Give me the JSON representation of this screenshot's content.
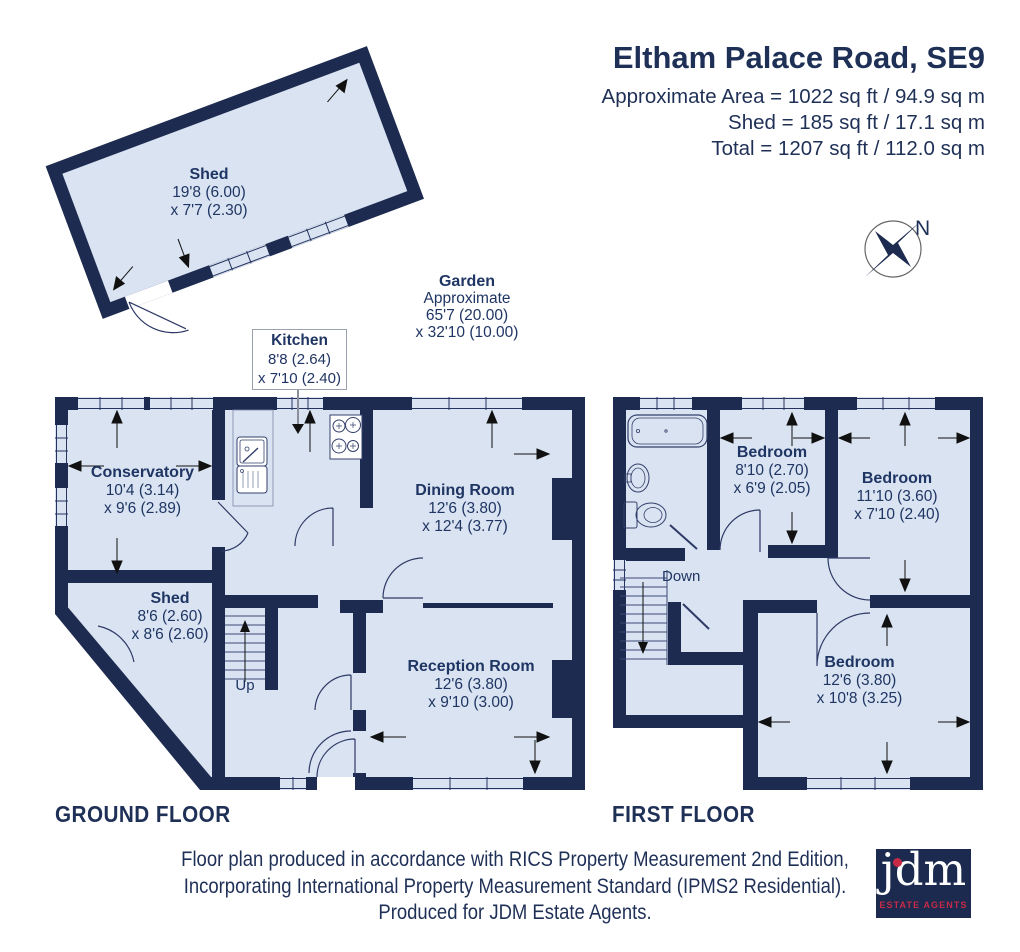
{
  "header": {
    "title": "Eltham Palace Road, SE9",
    "area_lines": [
      "Approximate Area = 1022 sq ft / 94.9 sq m",
      "Shed = 185 sq ft / 17.1 sq m",
      "Total = 1207 sq ft / 112.0 sq m"
    ]
  },
  "compass": {
    "north_label": "N"
  },
  "outbuilding_shed": {
    "name": "Shed",
    "dims": [
      "19'8 (6.00)",
      "x 7'7 (2.30)"
    ]
  },
  "garden": {
    "name": "Garden",
    "lines": [
      "Approximate",
      "65'7 (20.00)",
      "x 32'10 (10.00)"
    ]
  },
  "kitchen_callout": {
    "name": "Kitchen",
    "dims": [
      "8'8 (2.64)",
      "x 7'10 (2.40)"
    ]
  },
  "ground_floor": {
    "label": "GROUND FLOOR",
    "stairs_label": "Up",
    "rooms": {
      "conservatory": {
        "name": "Conservatory",
        "dims": [
          "10'4 (3.14)",
          "x 9'6 (2.89)"
        ]
      },
      "shed": {
        "name": "Shed",
        "dims": [
          "8'6 (2.60)",
          "x 8'6 (2.60)"
        ]
      },
      "dining": {
        "name": "Dining Room",
        "dims": [
          "12'6 (3.80)",
          "x 12'4 (3.77)"
        ]
      },
      "reception": {
        "name": "Reception Room",
        "dims": [
          "12'6 (3.80)",
          "x 9'10 (3.00)"
        ]
      }
    }
  },
  "first_floor": {
    "label": "FIRST FLOOR",
    "stairs_label": "Down",
    "rooms": {
      "bedroom_front": {
        "name": "Bedroom",
        "dims": [
          "8'10 (2.70)",
          "x 6'9 (2.05)"
        ]
      },
      "bedroom_right": {
        "name": "Bedroom",
        "dims": [
          "11'10 (3.60)",
          "x 7'10 (2.40)"
        ]
      },
      "bedroom_back": {
        "name": "Bedroom",
        "dims": [
          "12'6 (3.80)",
          "x 10'8 (3.25)"
        ]
      }
    }
  },
  "footer": {
    "lines": [
      "Floor plan produced in accordance with RICS Property Measurement 2nd Edition,",
      "Incorporating International Property Measurement Standard (IPMS2 Residential).",
      "Produced for JDM Estate Agents."
    ],
    "logo": {
      "brand": "jdm",
      "tagline": "ESTATE AGENTS"
    }
  },
  "colors": {
    "wall_navy": "#1e2b50",
    "room_fill": "#d9e3f1",
    "text_navy": "#1f3563",
    "logo_red": "#c62a46"
  }
}
